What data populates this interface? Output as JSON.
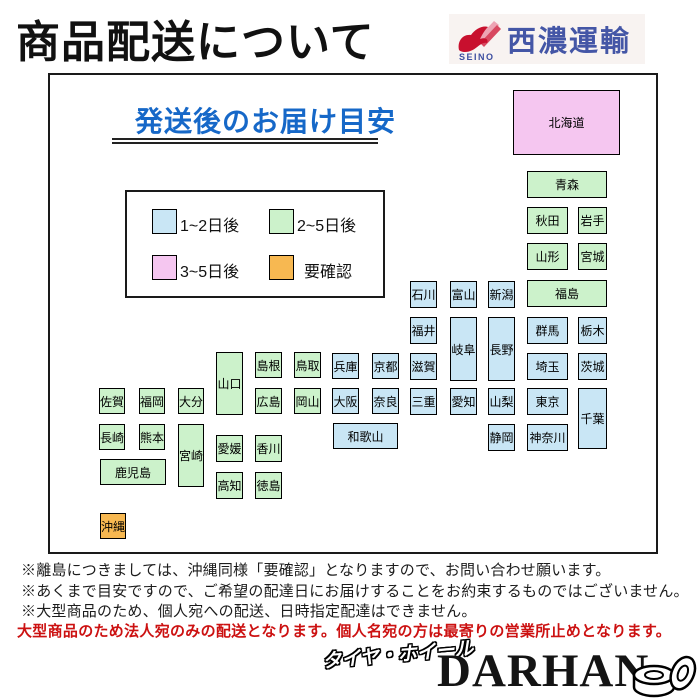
{
  "page_title": "商品配送について",
  "logo": {
    "name": "SEINO",
    "company": "西濃運輸"
  },
  "colors": {
    "blue": "#c9e6f5",
    "green": "#ccf2cb",
    "pink": "#f5c6f0",
    "orange": "#f7b851",
    "heading_blue": "#1668c8",
    "warning_red": "#cc1111",
    "logo_blue": "#4456a6",
    "logo_red": "#c8102e"
  },
  "panel": {
    "heading": "発送後のお届け目安",
    "legend": [
      {
        "label": "1~2日後",
        "color": "blue"
      },
      {
        "label": "2~5日後",
        "color": "green"
      },
      {
        "label": "3~5日後",
        "color": "pink"
      },
      {
        "label": "要確認",
        "color": "orange"
      }
    ],
    "prefectures": [
      {
        "name": "北海道",
        "color": "pink",
        "x": 513,
        "y": 90,
        "w": 107,
        "h": 65
      },
      {
        "name": "青森",
        "color": "green",
        "x": 527,
        "y": 171,
        "w": 80,
        "h": 27
      },
      {
        "name": "秋田",
        "color": "green",
        "x": 527,
        "y": 207,
        "w": 41,
        "h": 27
      },
      {
        "name": "岩手",
        "color": "green",
        "x": 578,
        "y": 207,
        "w": 29,
        "h": 27
      },
      {
        "name": "山形",
        "color": "green",
        "x": 527,
        "y": 243,
        "w": 41,
        "h": 27
      },
      {
        "name": "宮城",
        "color": "green",
        "x": 578,
        "y": 243,
        "w": 29,
        "h": 27
      },
      {
        "name": "福島",
        "color": "green",
        "x": 527,
        "y": 280,
        "w": 80,
        "h": 27
      },
      {
        "name": "新潟",
        "color": "blue",
        "x": 488,
        "y": 281,
        "w": 27,
        "h": 27
      },
      {
        "name": "富山",
        "color": "blue",
        "x": 450,
        "y": 281,
        "w": 27,
        "h": 27
      },
      {
        "name": "石川",
        "color": "blue",
        "x": 410,
        "y": 281,
        "w": 27,
        "h": 27
      },
      {
        "name": "福井",
        "color": "blue",
        "x": 410,
        "y": 317,
        "w": 27,
        "h": 27
      },
      {
        "name": "岐阜",
        "color": "blue",
        "x": 450,
        "y": 317,
        "w": 27,
        "h": 64
      },
      {
        "name": "長野",
        "color": "blue",
        "x": 488,
        "y": 317,
        "w": 27,
        "h": 64
      },
      {
        "name": "群馬",
        "color": "blue",
        "x": 527,
        "y": 317,
        "w": 41,
        "h": 27
      },
      {
        "name": "栃木",
        "color": "blue",
        "x": 578,
        "y": 317,
        "w": 29,
        "h": 27
      },
      {
        "name": "滋賀",
        "color": "blue",
        "x": 410,
        "y": 353,
        "w": 27,
        "h": 27
      },
      {
        "name": "埼玉",
        "color": "blue",
        "x": 527,
        "y": 353,
        "w": 41,
        "h": 27
      },
      {
        "name": "茨城",
        "color": "blue",
        "x": 578,
        "y": 353,
        "w": 29,
        "h": 27
      },
      {
        "name": "三重",
        "color": "blue",
        "x": 410,
        "y": 388,
        "w": 27,
        "h": 27
      },
      {
        "name": "愛知",
        "color": "blue",
        "x": 450,
        "y": 388,
        "w": 27,
        "h": 27
      },
      {
        "name": "山梨",
        "color": "blue",
        "x": 488,
        "y": 388,
        "w": 27,
        "h": 27
      },
      {
        "name": "東京",
        "color": "blue",
        "x": 527,
        "y": 388,
        "w": 41,
        "h": 27
      },
      {
        "name": "千葉",
        "color": "blue",
        "x": 578,
        "y": 388,
        "w": 29,
        "h": 61
      },
      {
        "name": "静岡",
        "color": "blue",
        "x": 488,
        "y": 424,
        "w": 27,
        "h": 27
      },
      {
        "name": "神奈川",
        "color": "blue",
        "x": 527,
        "y": 424,
        "w": 41,
        "h": 27
      },
      {
        "name": "兵庫",
        "color": "blue",
        "x": 332,
        "y": 353,
        "w": 27,
        "h": 26
      },
      {
        "name": "京都",
        "color": "blue",
        "x": 372,
        "y": 353,
        "w": 27,
        "h": 26
      },
      {
        "name": "大阪",
        "color": "blue",
        "x": 332,
        "y": 388,
        "w": 27,
        "h": 26
      },
      {
        "name": "奈良",
        "color": "blue",
        "x": 372,
        "y": 388,
        "w": 27,
        "h": 26
      },
      {
        "name": "和歌山",
        "color": "blue",
        "x": 333,
        "y": 423,
        "w": 65,
        "h": 26
      },
      {
        "name": "島根",
        "color": "green",
        "x": 255,
        "y": 352,
        "w": 27,
        "h": 26
      },
      {
        "name": "鳥取",
        "color": "green",
        "x": 294,
        "y": 352,
        "w": 27,
        "h": 26
      },
      {
        "name": "広島",
        "color": "green",
        "x": 255,
        "y": 388,
        "w": 27,
        "h": 26
      },
      {
        "name": "岡山",
        "color": "green",
        "x": 294,
        "y": 388,
        "w": 27,
        "h": 26
      },
      {
        "name": "山口",
        "color": "green",
        "x": 216,
        "y": 352,
        "w": 27,
        "h": 63
      },
      {
        "name": "愛媛",
        "color": "green",
        "x": 216,
        "y": 435,
        "w": 27,
        "h": 27
      },
      {
        "name": "香川",
        "color": "green",
        "x": 255,
        "y": 435,
        "w": 27,
        "h": 27
      },
      {
        "name": "高知",
        "color": "green",
        "x": 216,
        "y": 472,
        "w": 27,
        "h": 27
      },
      {
        "name": "徳島",
        "color": "green",
        "x": 255,
        "y": 472,
        "w": 27,
        "h": 27
      },
      {
        "name": "佐賀",
        "color": "green",
        "x": 99,
        "y": 388,
        "w": 26,
        "h": 26
      },
      {
        "name": "福岡",
        "color": "green",
        "x": 139,
        "y": 388,
        "w": 26,
        "h": 26
      },
      {
        "name": "大分",
        "color": "green",
        "x": 178,
        "y": 388,
        "w": 26,
        "h": 26
      },
      {
        "name": "長崎",
        "color": "green",
        "x": 99,
        "y": 424,
        "w": 26,
        "h": 26
      },
      {
        "name": "熊本",
        "color": "green",
        "x": 139,
        "y": 424,
        "w": 26,
        "h": 26
      },
      {
        "name": "宮崎",
        "color": "green",
        "x": 178,
        "y": 424,
        "w": 26,
        "h": 63
      },
      {
        "name": "鹿児島",
        "color": "green",
        "x": 100,
        "y": 459,
        "w": 66,
        "h": 26
      },
      {
        "name": "沖縄",
        "color": "orange",
        "x": 100,
        "y": 513,
        "w": 26,
        "h": 26
      }
    ]
  },
  "notes": [
    "※離島につきましては、沖縄同様「要確認」となりますので、お問い合わせ願います。",
    "※あくまで目安ですので、ご希望の配達日にお届けすることをお約束するものではございません。",
    "※大型商品のため、個人宛への配送、日時指定配達はできません。"
  ],
  "warning": "大型商品のため法人宛のみの配送となります。個人名宛の方は最寄りの営業所止めとなります。",
  "footer": {
    "tagline": "タイヤ・ホイール",
    "brand": "DARHAN"
  }
}
